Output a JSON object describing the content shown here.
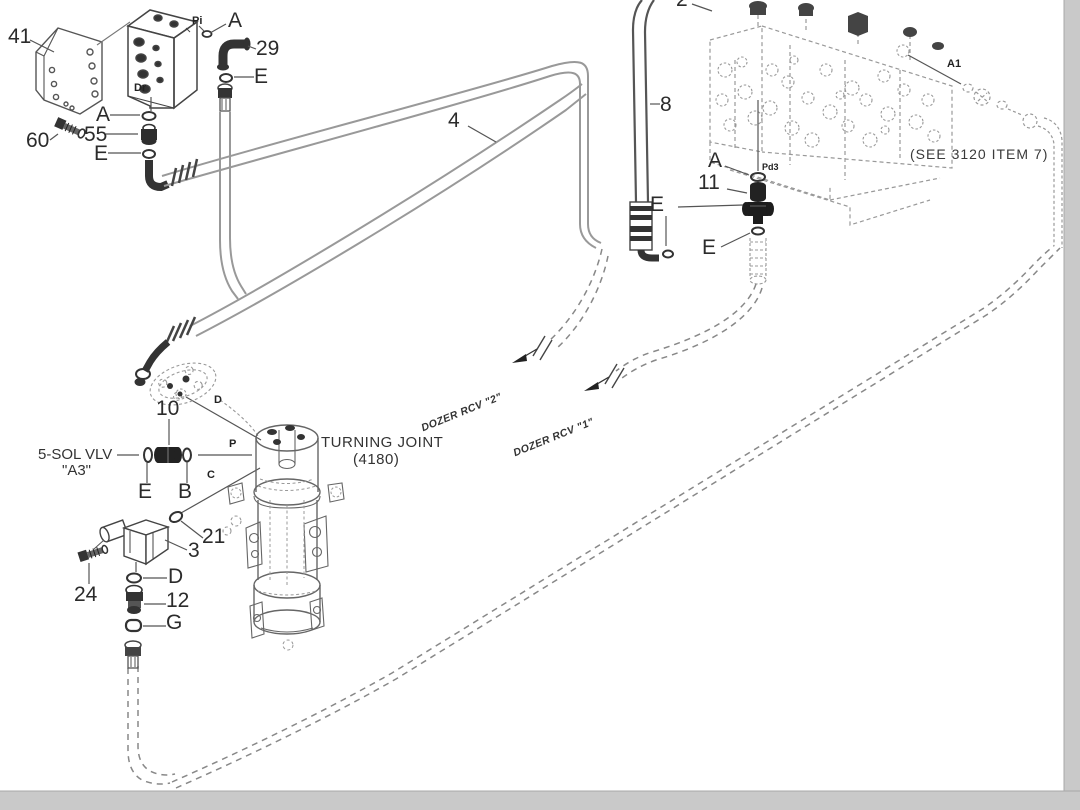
{
  "page": {
    "background": "#ffffff",
    "frame_color": "#c9c9c9",
    "line_color": "#444444",
    "hose_color": "#999999"
  },
  "callouts": {
    "c41": "41",
    "c60": "60",
    "c55": "55",
    "c29": "29",
    "c4": "4",
    "c8": "8",
    "c2": "2",
    "c11": "11",
    "c10": "10",
    "c21": "21",
    "c3": "3",
    "c24": "24",
    "c12": "12"
  },
  "fitting_letters": {
    "a_top": "A",
    "a_55": "A",
    "a_tee": "A",
    "e_29": "E",
    "e_55": "E",
    "e_hose8": "E",
    "e_tee": "E",
    "e_sol": "E",
    "b_sol": "B",
    "d_12": "D",
    "g_12": "G"
  },
  "ports": {
    "pi": "Pi",
    "dr": "Dr",
    "pd3": "Pd3",
    "a1": "A1",
    "p": "P",
    "c": "C",
    "d": "D"
  },
  "annotations": {
    "see_ref": "(SEE 3120 ITEM 7)",
    "turning_joint": "TURNING JOINT",
    "turning_joint_code": "(4180)",
    "sol_valve": "5-SOL VLV",
    "sol_valve_name": "\"A3\"",
    "dozer_rcv_2": "DOZER RCV \"2\"",
    "dozer_rcv_1": "DOZER RCV \"1\""
  }
}
